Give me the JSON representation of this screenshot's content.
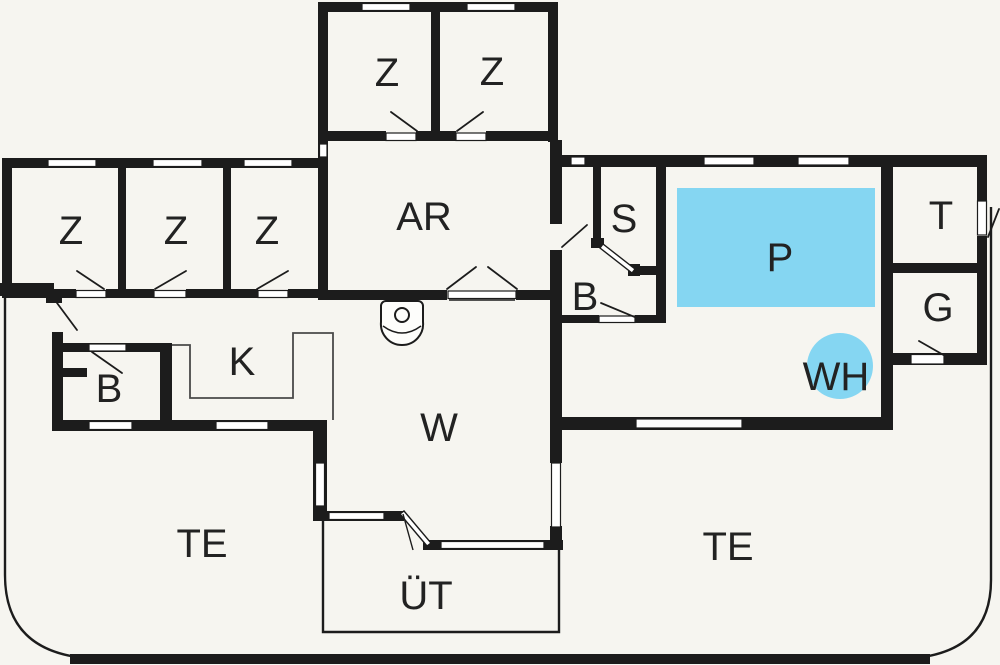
{
  "colors": {
    "wall": "#1c1c1c",
    "water": "#85d6f2",
    "background": "#f6f5f0",
    "label": "#222222"
  },
  "rooms": {
    "z_top_left": {
      "label": "Z"
    },
    "z_top_right": {
      "label": "Z"
    },
    "z_west_1": {
      "label": "Z"
    },
    "z_west_2": {
      "label": "Z"
    },
    "z_west_3": {
      "label": "Z"
    },
    "ar": {
      "label": "AR"
    },
    "s": {
      "label": "S"
    },
    "b_east": {
      "label": "B"
    },
    "pool": {
      "label": "P"
    },
    "t": {
      "label": "T"
    },
    "g": {
      "label": "G"
    },
    "wh": {
      "label": "WH"
    },
    "b_west": {
      "label": "B"
    },
    "k": {
      "label": "K"
    },
    "w": {
      "label": "W"
    },
    "te_west": {
      "label": "TE"
    },
    "te_east": {
      "label": "TE"
    },
    "ut": {
      "label": "ÜT"
    }
  }
}
